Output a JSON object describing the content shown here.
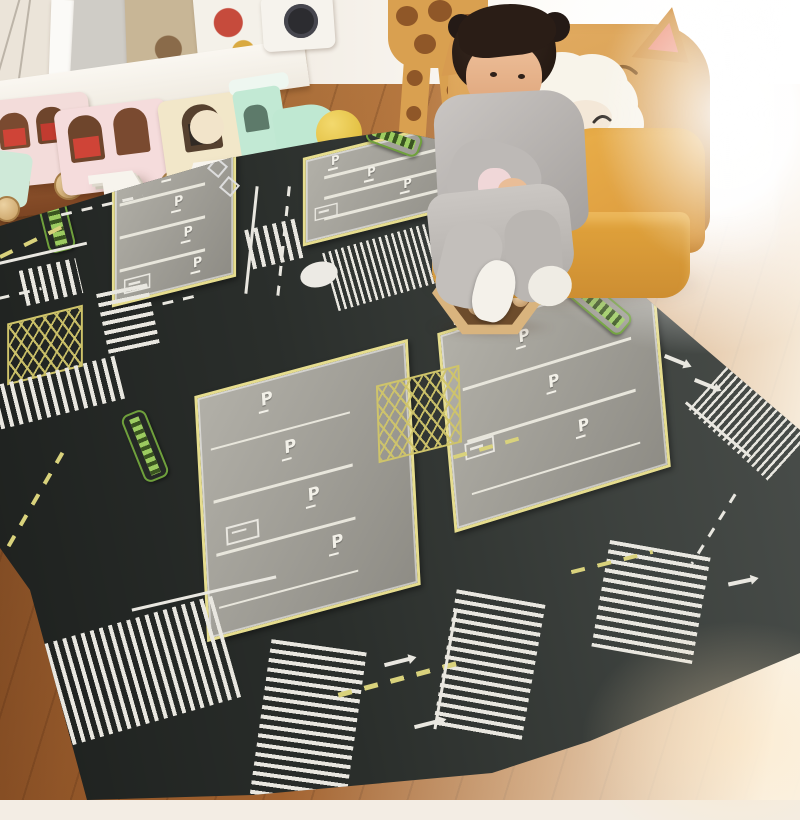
{
  "scene": {
    "letters": {
      "first": "M",
      "second": "L"
    },
    "rug": {
      "parking_label": "P",
      "colors": {
        "base": "#2a2e2b",
        "lot": "#a3a19b",
        "lot_border": "#e6dd8e",
        "white_line": "#e9e7e0",
        "yellow_line": "#d9d27c",
        "green_strip": "#9ccb60"
      },
      "parking_lots": [
        {
          "position": "top-left",
          "stalls": 4
        },
        {
          "position": "top-center",
          "stalls": 4
        },
        {
          "position": "center",
          "stalls": 4
        },
        {
          "position": "right",
          "stalls": 3
        }
      ]
    },
    "chair": {
      "seat_color": "#e2a43c",
      "back_color": "#d79b50",
      "ear_color": "#ef9a84"
    },
    "child": {
      "hair_color": "#2a1d16",
      "pajama_color": "#bdb9b6",
      "skin_color": "#e9bd97"
    },
    "plush_sheep_color": "#f8f4ea",
    "train": {
      "wagon_pink": "#f5dcdc",
      "wagon_cream": "#f2e7c9",
      "engine_mint": "#bfe8d2",
      "wheel_color": "#d9b47e"
    },
    "floor_color": "#b5773f",
    "ball_tray": {
      "frame_color": "#d9b47e",
      "ball_color": "#caa06c"
    }
  }
}
